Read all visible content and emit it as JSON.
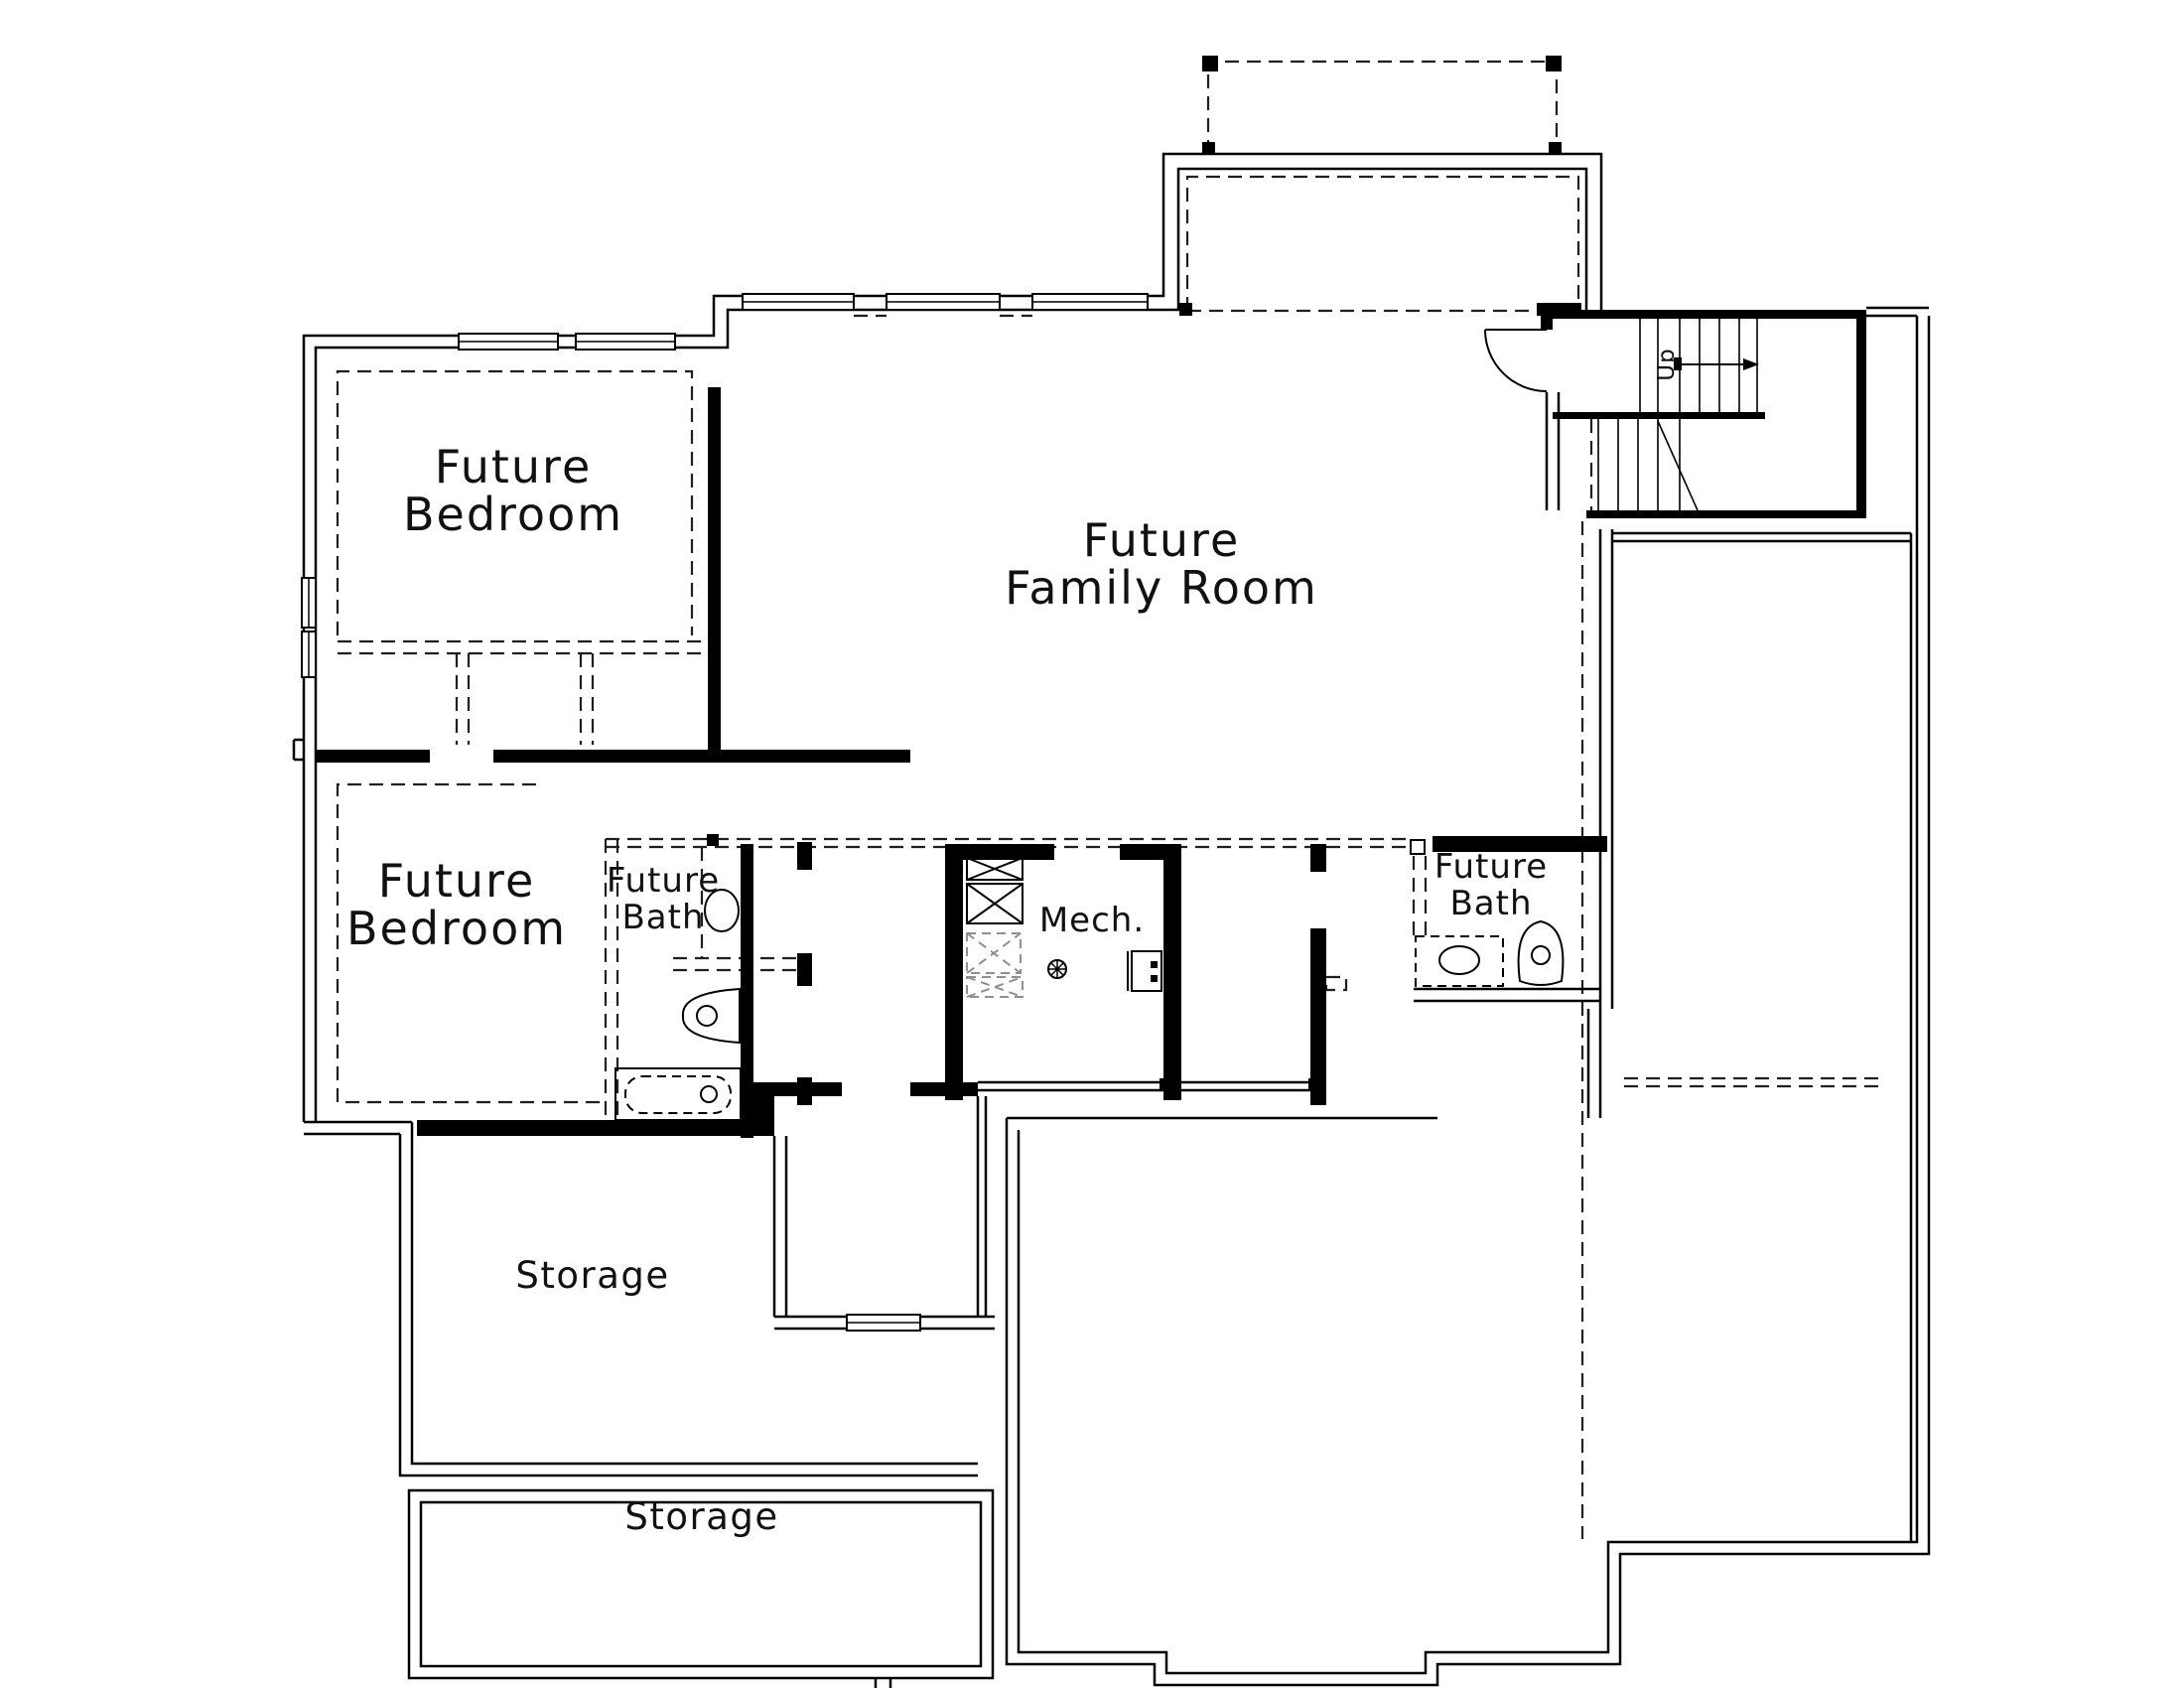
{
  "document": {
    "type": "architectural-floor-plan",
    "level": "basement-future-finish"
  },
  "colors": {
    "background": "#ffffff",
    "wall_line": "#000000",
    "future_wall_line": "#1f1f1f",
    "future_fixture_line": "#8f8f8f",
    "text": "#111111"
  },
  "rooms": [
    {
      "id": "future-bedroom-1",
      "label_lines": [
        "Future",
        "Bedroom"
      ]
    },
    {
      "id": "future-family-room",
      "label_lines": [
        "Future",
        "Family Room"
      ]
    },
    {
      "id": "future-bedroom-2",
      "label_lines": [
        "Future",
        "Bedroom"
      ]
    },
    {
      "id": "future-bath-1",
      "label_lines": [
        "Future",
        "Bath"
      ]
    },
    {
      "id": "mechanical-room",
      "label_lines": [
        "Mech."
      ]
    },
    {
      "id": "future-bath-2",
      "label_lines": [
        "Future",
        "Bath"
      ]
    },
    {
      "id": "storage-1",
      "label_lines": [
        "Storage"
      ]
    },
    {
      "id": "storage-2",
      "label_lines": [
        "Storage"
      ]
    }
  ],
  "stairs": {
    "direction_label": "Up"
  },
  "fixture_symbols": [
    "window",
    "door-swing",
    "deck-post",
    "stair-treads",
    "bathtub",
    "toilet",
    "vanity-sink",
    "hvac-unit",
    "future-hvac-unit",
    "floor-drain",
    "water-heater"
  ]
}
